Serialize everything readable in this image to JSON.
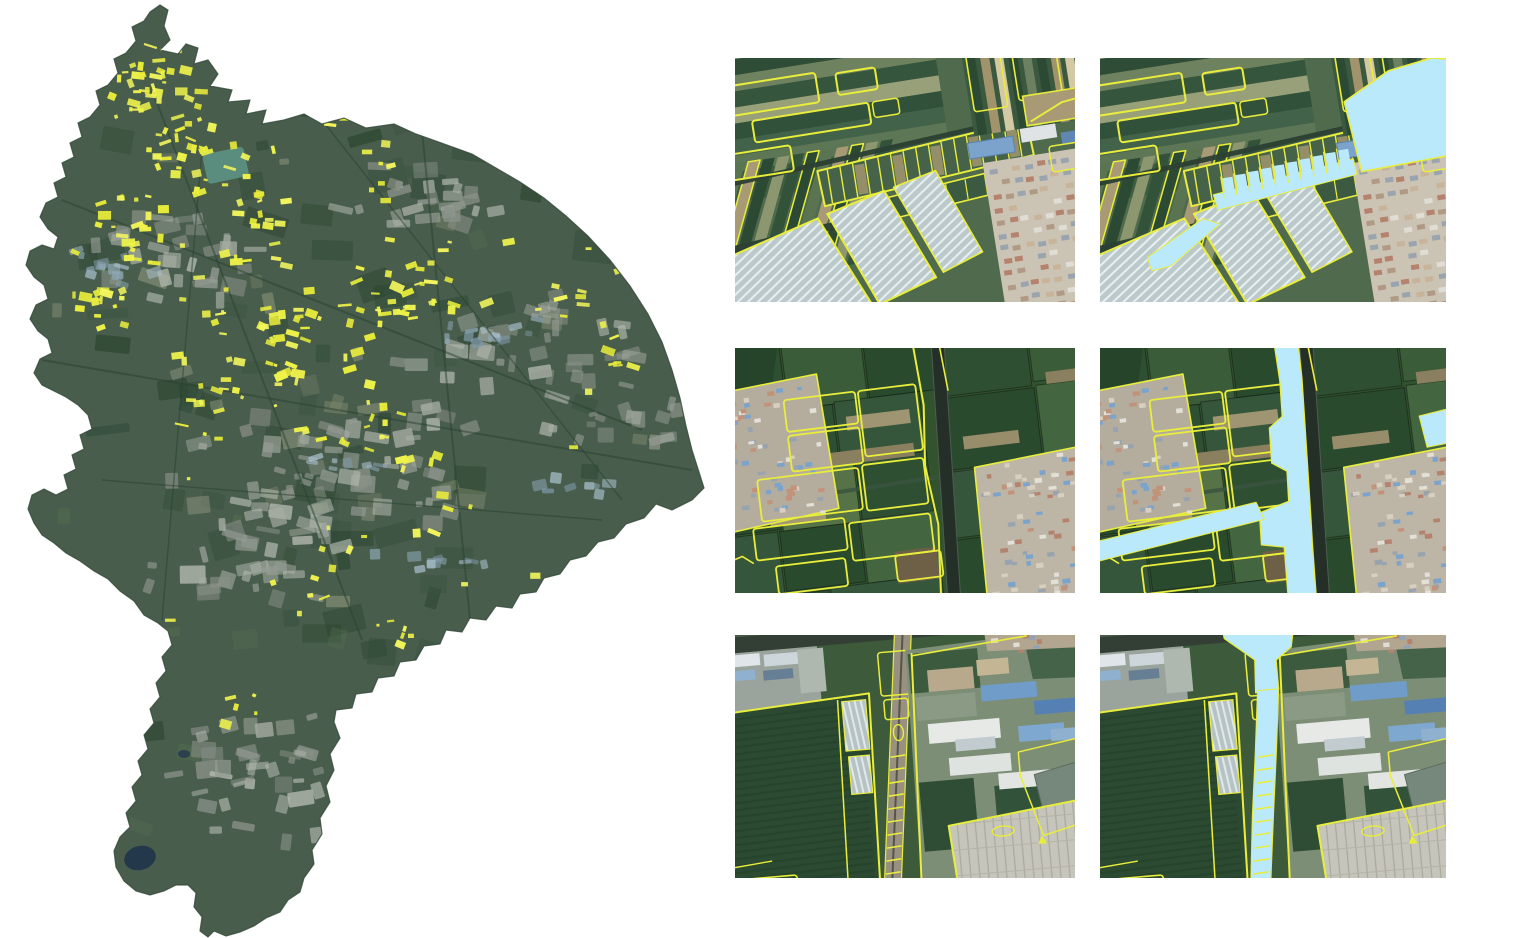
{
  "figure": {
    "background": "#ffffff",
    "region_map": {
      "id": "study-area-map",
      "kind": "satellite-mosaic-with-parcel-highlights",
      "highlight": "yellow-parcels"
    },
    "panels": [
      {
        "id": "sample-1-outlines",
        "row": 1,
        "col": 1,
        "overlay": "outlines"
      },
      {
        "id": "sample-1-fills",
        "row": 1,
        "col": 2,
        "overlay": "outlines-and-fills"
      },
      {
        "id": "sample-2-outlines",
        "row": 2,
        "col": 1,
        "overlay": "outlines"
      },
      {
        "id": "sample-2-fills",
        "row": 2,
        "col": 2,
        "overlay": "outlines-and-fills"
      },
      {
        "id": "sample-3-outlines",
        "row": 3,
        "col": 1,
        "overlay": "outlines"
      },
      {
        "id": "sample-3-fills",
        "row": 3,
        "col": 2,
        "overlay": "outlines-and-fills"
      }
    ],
    "colors": {
      "outline_yellow": "#e9ed3c",
      "speckle_yellow": "#eef24a",
      "fill_cyan": "#b9e9fb",
      "field_dark": "#2c4a33",
      "field_mid": "#4a6648",
      "field_deep": "#2a4a2e",
      "soil_tan": "#a89a74",
      "greenhouse": "#bcc9cb",
      "urban_base": "#cbc4b4",
      "roof_red": "#b5826d",
      "roof_blue": "#7ba3cc",
      "roof_white": "#e2e5e3",
      "road_dark": "#2c4033",
      "water_dark": "#23384a",
      "map_base": "#495d4c"
    }
  }
}
